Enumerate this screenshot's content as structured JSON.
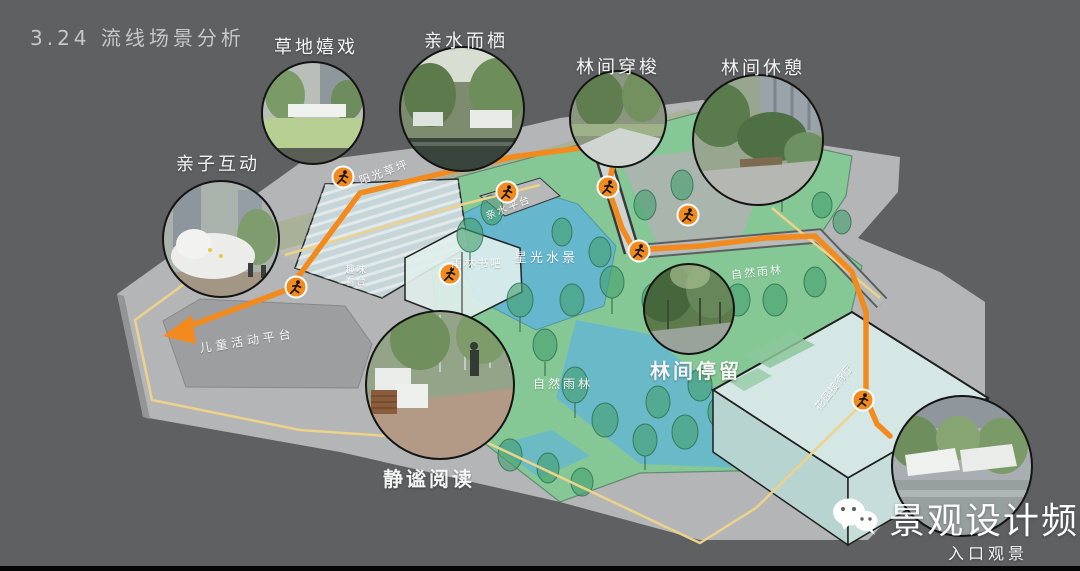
{
  "title": "3.24  流线场景分析",
  "scenes": [
    {
      "id": "grass-play",
      "label": "草地嬉戏"
    },
    {
      "id": "waterside-rest",
      "label": "亲水而栖"
    },
    {
      "id": "forest-shuttle",
      "label": "林间穿梭"
    },
    {
      "id": "forest-rest",
      "label": "林间休憩"
    },
    {
      "id": "parent-child",
      "label": "亲子互动"
    },
    {
      "id": "quiet-reading",
      "label": "静谧阅读"
    },
    {
      "id": "forest-stay",
      "label": "林间停留"
    },
    {
      "id": "entrance-view",
      "label": "入口观景"
    }
  ],
  "plan_labels": [
    {
      "id": "sunny-lawn",
      "text": "阳光草坪"
    },
    {
      "id": "waterfront-platform",
      "text": "亲水平台"
    },
    {
      "id": "starlight-water",
      "text": "星光水景"
    },
    {
      "id": "rainforest-bookbar",
      "text": "雨林书吧"
    },
    {
      "id": "fun-stand",
      "text": "趣味看台"
    },
    {
      "id": "children-activity-platform",
      "text": "儿童活动平台"
    },
    {
      "id": "natural-rainforest-1",
      "text": "自然雨林"
    },
    {
      "id": "natural-rainforest-2",
      "text": "自然雨林"
    },
    {
      "id": "garden-reception-hall",
      "text": "花园接待厅"
    }
  ],
  "route": {
    "marker": "runner-icon",
    "marker_count": 8,
    "color": "#F28A1E"
  },
  "watermark": {
    "icon": "wechat-icon",
    "channel_name": "景观设计频道"
  },
  "colors": {
    "background": "#5E6062",
    "base_platform": "#B4B5B7",
    "dark_platform": "#9D9EA0",
    "lawn_band": "#A9B199",
    "greenery": "#85C896",
    "tree": "#52A478",
    "water": "#66B7CD",
    "route_orange": "#F28A1E",
    "path_yellow": "#ECD28A",
    "building_glass": "#D4E7E5"
  }
}
